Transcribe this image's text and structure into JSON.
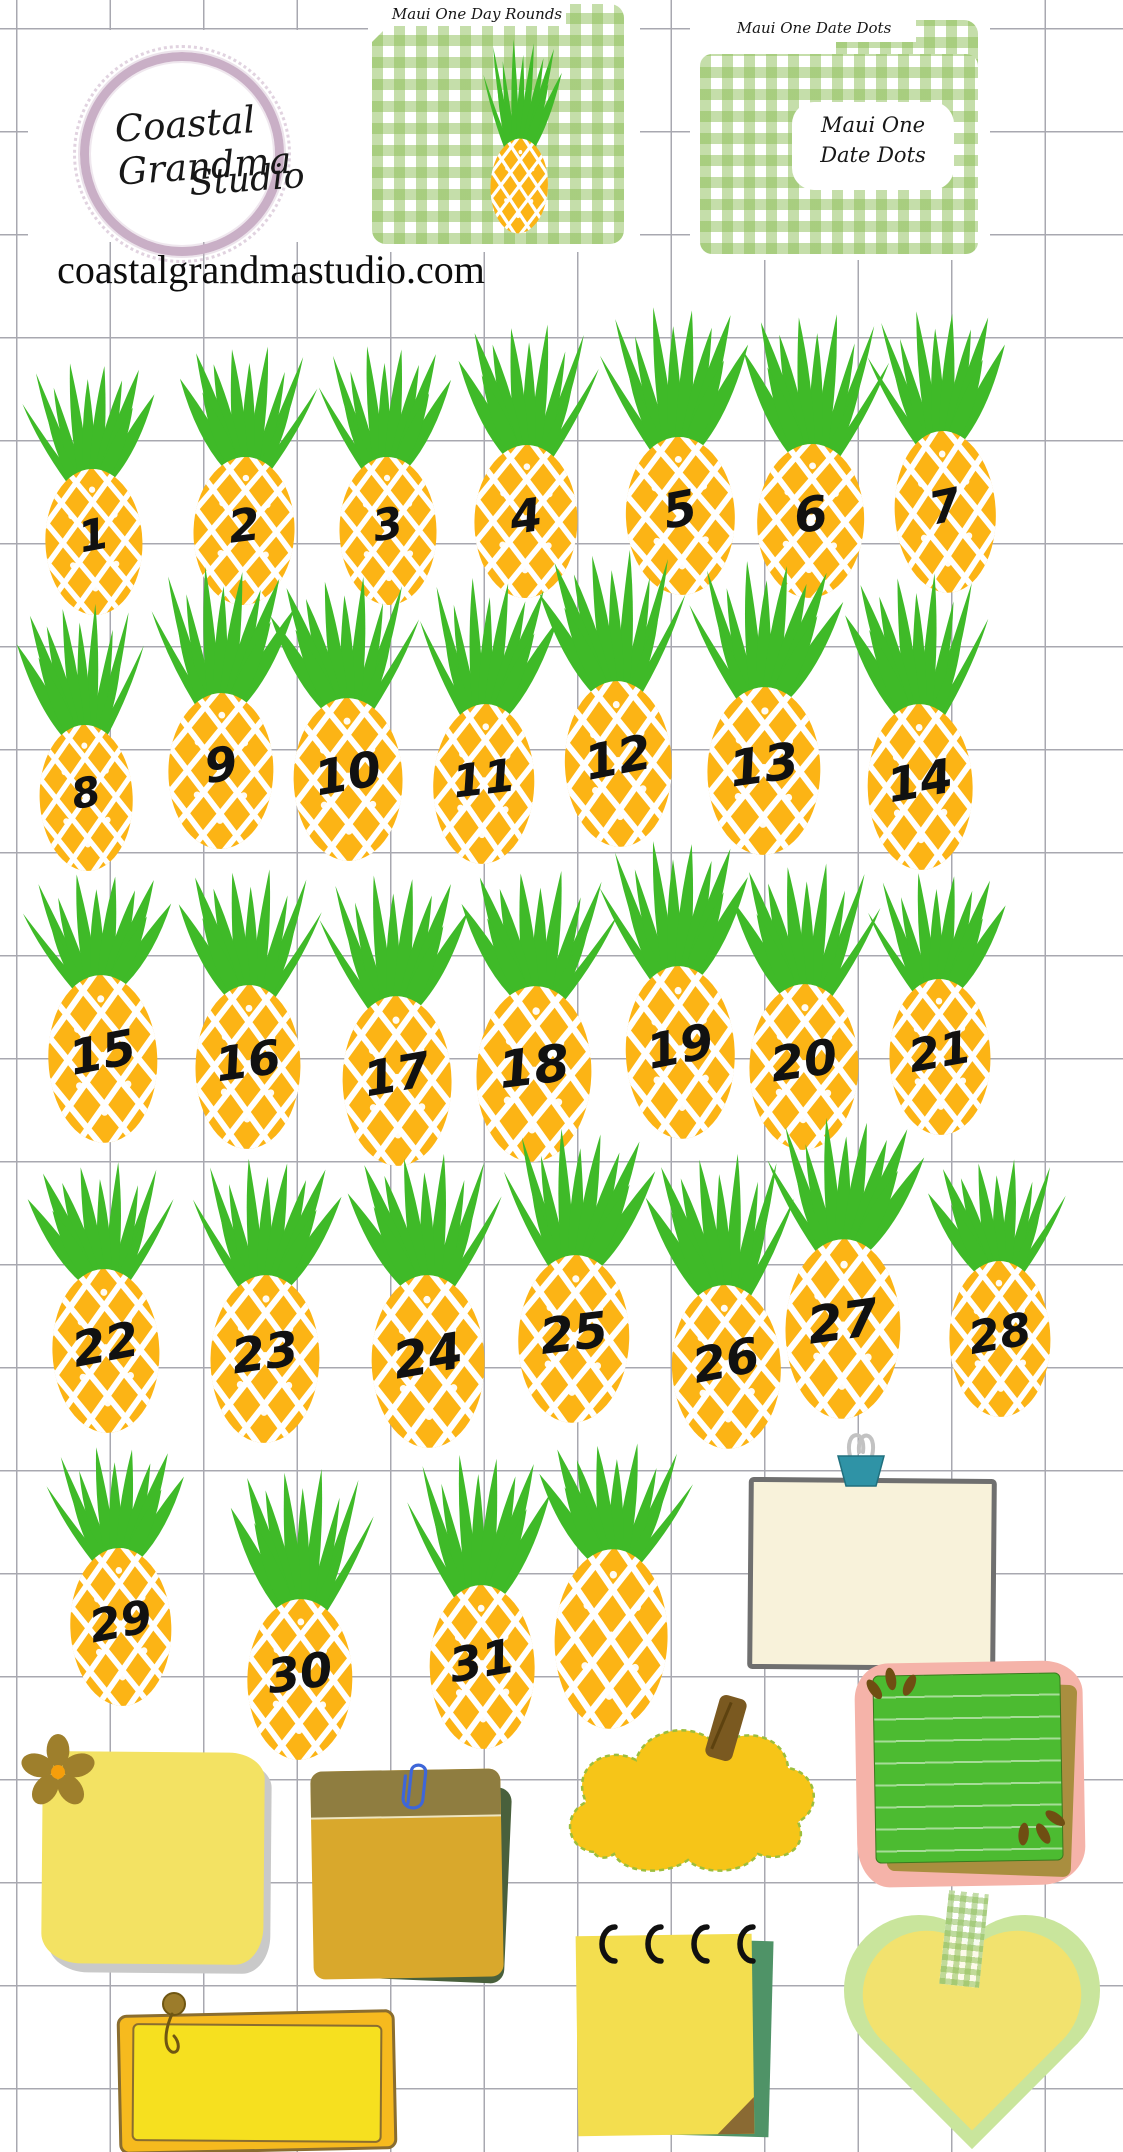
{
  "brand": {
    "name_line1": "Coastal Grandma",
    "name_line2": "Studio",
    "website": "coastalgrandmastudio.com"
  },
  "folders": [
    {
      "tab_label": "Maui One Day Rounds"
    },
    {
      "tab_label": "Maui One Date Dots",
      "card_line1": "Maui One",
      "card_line2": "Date Dots"
    }
  ],
  "date_dots": {
    "numbers": [
      "1",
      "2",
      "3",
      "4",
      "5",
      "6",
      "7",
      "8",
      "9",
      "10",
      "11",
      "12",
      "13",
      "14",
      "15",
      "16",
      "17",
      "18",
      "19",
      "20",
      "21",
      "22",
      "23",
      "24",
      "25",
      "26",
      "27",
      "28",
      "29",
      "30",
      "31",
      ""
    ]
  },
  "colors": {
    "pineapple_gold": "#FCB415",
    "crown_green": "#3FBA28",
    "gingham_green": "#8BBD55",
    "logo_ring_mauve": "#C9AFC6",
    "number_black": "#111111",
    "binder_clip_teal": "#2F93A6",
    "note_cream": "#F8F2DA",
    "sticky_yellow": "#F3E263",
    "clipboard_mustard": "#D9A82C",
    "cloud_yellow": "#F6C518",
    "lined_note_green": "#4CBB31",
    "note_border_pink": "#F5B3A9",
    "bright_note_yellow": "#F6E01F",
    "pad_yellow": "#F3DE4F",
    "heart_yellow": "#F2E26E",
    "heart_border_green": "#C9E59C"
  }
}
